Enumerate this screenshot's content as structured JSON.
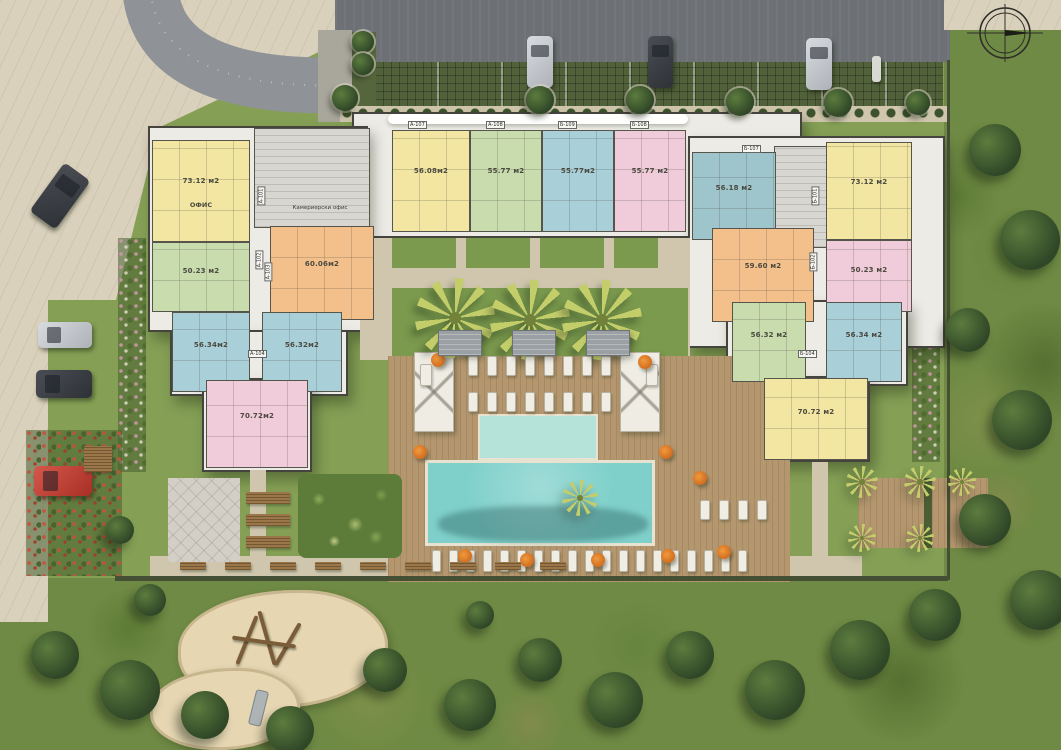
{
  "site": {
    "labels": {
      "office": "ОФИС",
      "housekeeping_office": "Камериерски офис"
    },
    "compass": "north-arrow-icon"
  },
  "palette": {
    "unit_yellow": "#f2e6a2",
    "unit_green": "#c9dcae",
    "unit_blue": "#a9cfd8",
    "unit_teal": "#9ec4cc",
    "unit_pink": "#f0cbd9",
    "unit_orange": "#f3c08b",
    "pool": "#7fd0ca",
    "kids_pool": "#b5e3da",
    "deck_wood": "#b4976f",
    "lawn": "#85a055",
    "path": "#cfc6ad",
    "umbrella_orange": "#e07b28"
  },
  "units": [
    {
      "label": "73.12 м2",
      "sub": "ОФИС",
      "color": "yellow",
      "x": 152,
      "y": 140,
      "w": 98,
      "h": 102
    },
    {
      "label": "50.23 м2",
      "color": "green",
      "x": 152,
      "y": 242,
      "w": 98,
      "h": 70
    },
    {
      "label": "60.06м2",
      "color": "orange",
      "x": 270,
      "y": 226,
      "w": 104,
      "h": 94
    },
    {
      "label": "56.34м2",
      "color": "blue",
      "x": 172,
      "y": 312,
      "w": 78,
      "h": 80
    },
    {
      "label": "56.32м2",
      "color": "blue",
      "x": 262,
      "y": 312,
      "w": 80,
      "h": 80
    },
    {
      "label": "70.72м2",
      "color": "pink",
      "x": 206,
      "y": 380,
      "w": 102,
      "h": 88
    },
    {
      "label": "56.08м2",
      "color": "yellow",
      "x": 392,
      "y": 130,
      "w": 78,
      "h": 102
    },
    {
      "label": "55.77 м2",
      "color": "green",
      "x": 470,
      "y": 130,
      "w": 72,
      "h": 102
    },
    {
      "label": "55.77м2",
      "color": "blue",
      "x": 542,
      "y": 130,
      "w": 72,
      "h": 102
    },
    {
      "label": "55.77 м2",
      "color": "pink",
      "x": 614,
      "y": 130,
      "w": 72,
      "h": 102
    },
    {
      "label": "56.18 м2",
      "color": "teal",
      "x": 692,
      "y": 152,
      "w": 84,
      "h": 88
    },
    {
      "label": "73.12 м2",
      "color": "yellow",
      "x": 826,
      "y": 142,
      "w": 86,
      "h": 98
    },
    {
      "label": "50.23 м2",
      "color": "pink",
      "x": 826,
      "y": 240,
      "w": 86,
      "h": 72
    },
    {
      "label": "59.60 м2",
      "color": "orange",
      "x": 712,
      "y": 228,
      "w": 102,
      "h": 94
    },
    {
      "label": "56.32 м2",
      "color": "green",
      "x": 732,
      "y": 302,
      "w": 74,
      "h": 80
    },
    {
      "label": "56.34 м2",
      "color": "blue",
      "x": 826,
      "y": 302,
      "w": 76,
      "h": 80
    },
    {
      "label": "70.72 м2",
      "color": "yellow",
      "x": 764,
      "y": 378,
      "w": 104,
      "h": 82
    }
  ],
  "unit_codes": [
    {
      "text": "А-101",
      "x": 252,
      "y": 192,
      "rot": -90
    },
    {
      "text": "А-102",
      "x": 250,
      "y": 256,
      "rot": -90
    },
    {
      "text": "А-103",
      "x": 259,
      "y": 268,
      "rot": -90
    },
    {
      "text": "А-104",
      "x": 248,
      "y": 350,
      "rot": 0
    },
    {
      "text": "А-107",
      "x": 408,
      "y": 121,
      "rot": 0
    },
    {
      "text": "А-108",
      "x": 486,
      "y": 121,
      "rot": 0
    },
    {
      "text": "Б-109",
      "x": 558,
      "y": 121,
      "rot": 0
    },
    {
      "text": "Б-108",
      "x": 630,
      "y": 121,
      "rot": 0
    },
    {
      "text": "Б-107",
      "x": 742,
      "y": 145,
      "rot": 0
    },
    {
      "text": "Б-101",
      "x": 806,
      "y": 192,
      "rot": -90
    },
    {
      "text": "Б-102",
      "x": 804,
      "y": 258,
      "rot": -90
    },
    {
      "text": "Б-104",
      "x": 798,
      "y": 350,
      "rot": 0
    }
  ],
  "vehicles": {
    "cars": [
      {
        "x": 527,
        "y": 36,
        "w": 26,
        "h": 52,
        "color": "silver",
        "rot": 0,
        "dir": "v"
      },
      {
        "x": 648,
        "y": 36,
        "w": 25,
        "h": 52,
        "color": "dark",
        "rot": 0,
        "dir": "v"
      },
      {
        "x": 806,
        "y": 38,
        "w": 26,
        "h": 52,
        "color": "silver",
        "rot": 0,
        "dir": "v"
      },
      {
        "x": 44,
        "y": 166,
        "w": 32,
        "h": 60,
        "color": "dark",
        "rot": 36,
        "dir": "v"
      },
      {
        "x": 38,
        "y": 322,
        "w": 54,
        "h": 26,
        "color": "silver",
        "rot": 0,
        "dir": "h"
      },
      {
        "x": 36,
        "y": 370,
        "w": 56,
        "h": 28,
        "color": "dark",
        "rot": 0,
        "dir": "h"
      },
      {
        "x": 34,
        "y": 466,
        "w": 58,
        "h": 30,
        "color": "red",
        "rot": 0,
        "dir": "h"
      }
    ],
    "moto": {
      "x": 872,
      "y": 56,
      "w": 9,
      "h": 26
    }
  },
  "trees": {
    "trimmed": [
      {
        "x": 345,
        "y": 98,
        "r": 13
      },
      {
        "x": 363,
        "y": 42,
        "r": 11
      },
      {
        "x": 363,
        "y": 64,
        "r": 11
      },
      {
        "x": 540,
        "y": 100,
        "r": 14
      },
      {
        "x": 640,
        "y": 100,
        "r": 14
      },
      {
        "x": 740,
        "y": 102,
        "r": 14
      },
      {
        "x": 838,
        "y": 103,
        "r": 14
      },
      {
        "x": 918,
        "y": 103,
        "r": 12
      }
    ],
    "wild": [
      {
        "x": 995,
        "y": 150,
        "r": 26
      },
      {
        "x": 1030,
        "y": 240,
        "r": 30
      },
      {
        "x": 968,
        "y": 330,
        "r": 22
      },
      {
        "x": 1022,
        "y": 420,
        "r": 30
      },
      {
        "x": 985,
        "y": 520,
        "r": 26
      },
      {
        "x": 1040,
        "y": 600,
        "r": 30
      },
      {
        "x": 935,
        "y": 615,
        "r": 26
      },
      {
        "x": 860,
        "y": 650,
        "r": 30
      },
      {
        "x": 775,
        "y": 690,
        "r": 30
      },
      {
        "x": 690,
        "y": 655,
        "r": 24
      },
      {
        "x": 615,
        "y": 700,
        "r": 28
      },
      {
        "x": 540,
        "y": 660,
        "r": 22
      },
      {
        "x": 470,
        "y": 705,
        "r": 26
      },
      {
        "x": 385,
        "y": 670,
        "r": 22
      },
      {
        "x": 290,
        "y": 730,
        "r": 24
      },
      {
        "x": 205,
        "y": 715,
        "r": 24
      },
      {
        "x": 130,
        "y": 690,
        "r": 30
      },
      {
        "x": 55,
        "y": 655,
        "r": 24
      },
      {
        "x": 150,
        "y": 600,
        "r": 16
      },
      {
        "x": 480,
        "y": 615,
        "r": 14
      },
      {
        "x": 120,
        "y": 530,
        "r": 14
      }
    ]
  },
  "palms": {
    "large": [
      {
        "x": 455,
        "y": 318,
        "r": 40
      },
      {
        "x": 530,
        "y": 320,
        "r": 40
      },
      {
        "x": 602,
        "y": 320,
        "r": 40
      }
    ],
    "small": [
      {
        "x": 862,
        "y": 482,
        "r": 16
      },
      {
        "x": 920,
        "y": 482,
        "r": 16
      },
      {
        "x": 962,
        "y": 482,
        "r": 14
      },
      {
        "x": 862,
        "y": 538,
        "r": 14
      },
      {
        "x": 920,
        "y": 538,
        "r": 14
      },
      {
        "x": 580,
        "y": 498,
        "r": 18
      }
    ]
  },
  "loungers": [
    {
      "x": 432,
      "y": 550,
      "count": 19,
      "step": 17,
      "w": 9,
      "h": 22
    },
    {
      "x": 468,
      "y": 356,
      "count": 8,
      "step": 19,
      "w": 10,
      "h": 20
    },
    {
      "x": 468,
      "y": 392,
      "count": 8,
      "step": 19,
      "w": 10,
      "h": 20
    },
    {
      "x": 700,
      "y": 500,
      "count": 4,
      "step": 19,
      "w": 10,
      "h": 20
    },
    {
      "x": 420,
      "y": 364,
      "count": 1,
      "step": 0,
      "w": 12,
      "h": 22
    },
    {
      "x": 646,
      "y": 364,
      "count": 1,
      "step": 0,
      "w": 12,
      "h": 22
    }
  ],
  "umbrellas": [
    {
      "x": 438,
      "y": 360
    },
    {
      "x": 645,
      "y": 362
    },
    {
      "x": 420,
      "y": 452
    },
    {
      "x": 666,
      "y": 452
    },
    {
      "x": 465,
      "y": 556
    },
    {
      "x": 527,
      "y": 560
    },
    {
      "x": 598,
      "y": 560
    },
    {
      "x": 668,
      "y": 556
    },
    {
      "x": 724,
      "y": 552
    },
    {
      "x": 700,
      "y": 478
    }
  ],
  "pergolas": [
    {
      "x": 438,
      "y": 330,
      "w": 44,
      "h": 26
    },
    {
      "x": 512,
      "y": 330,
      "w": 44,
      "h": 26
    },
    {
      "x": 586,
      "y": 330,
      "w": 44,
      "h": 26
    }
  ],
  "benches": {
    "plaza": [
      {
        "x": 246,
        "y": 492,
        "w": 44,
        "h": 12
      },
      {
        "x": 246,
        "y": 514,
        "w": 44,
        "h": 12
      },
      {
        "x": 246,
        "y": 536,
        "w": 44,
        "h": 12
      },
      {
        "x": 84,
        "y": 446,
        "w": 28,
        "h": 26
      }
    ],
    "row": {
      "x": 180,
      "y": 562,
      "count": 9,
      "step": 45,
      "w": 26,
      "h": 8
    }
  }
}
